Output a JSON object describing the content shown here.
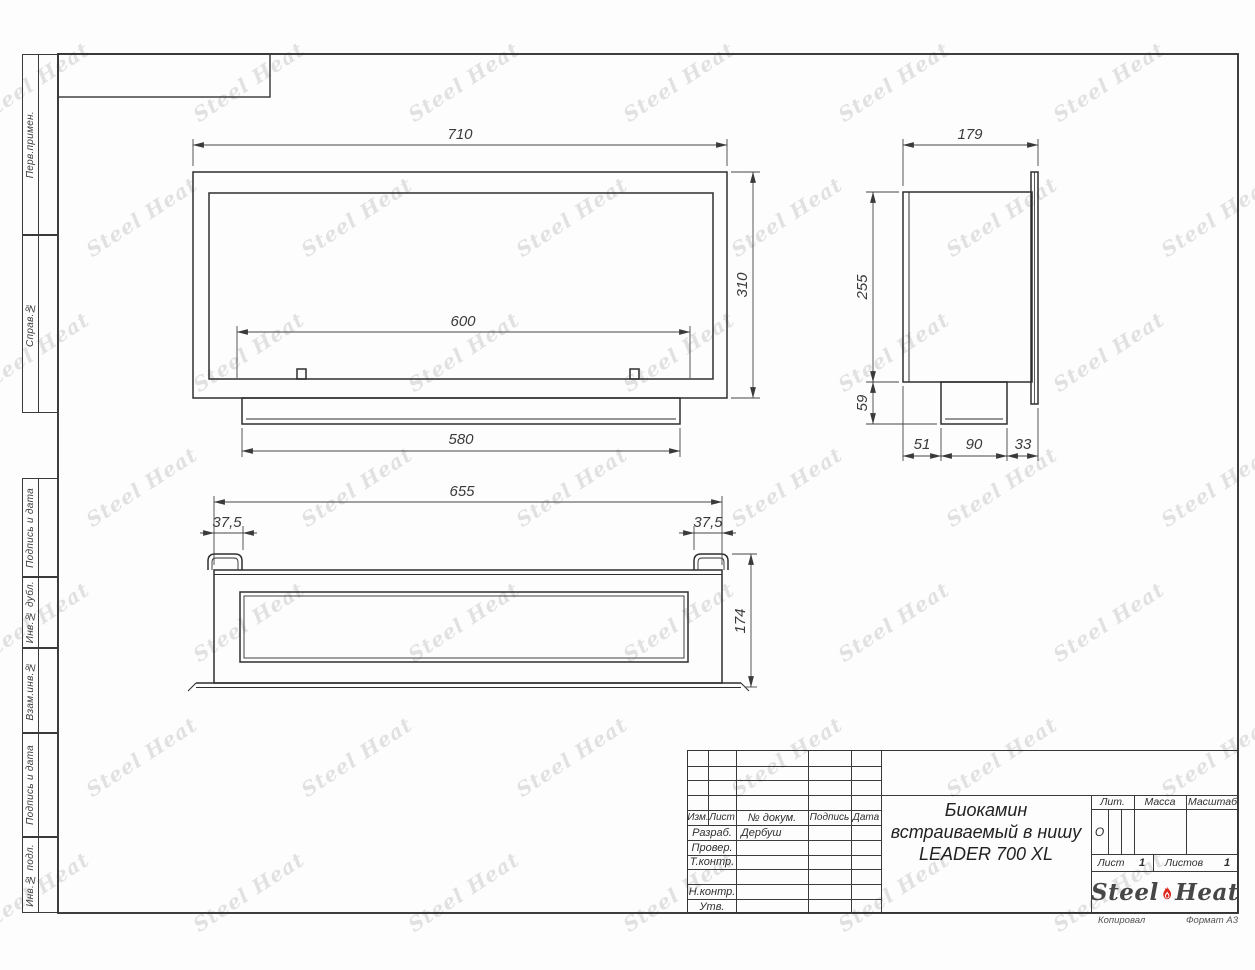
{
  "margins": {
    "items": [
      "Перв.примен.",
      "Справ.№",
      "Подпись и дата",
      "Инв.№ дубл.",
      "Взам.инв.№",
      "Подпись и дата",
      "Инв.№ подл."
    ]
  },
  "views": {
    "front": {
      "w": "710",
      "h": "310",
      "opening": "600",
      "base": "580"
    },
    "side": {
      "depth": "179",
      "h": "255",
      "foot": "59",
      "b1": "51",
      "b2": "90",
      "b3": "33"
    },
    "bottom": {
      "w": "655",
      "off_l": "37,5",
      "off_r": "37,5",
      "d": "174"
    }
  },
  "title_block": {
    "cols": [
      "Изм.",
      "Лист",
      "№ докум.",
      "Подпись",
      "Дата"
    ],
    "rows": [
      {
        "label": "Разраб.",
        "value": "Дербуш"
      },
      {
        "label": "Провер.",
        "value": ""
      },
      {
        "label": "Т.контр.",
        "value": ""
      },
      {
        "label": "",
        "value": ""
      },
      {
        "label": "Н.контр.",
        "value": ""
      },
      {
        "label": "Утв.",
        "value": ""
      }
    ],
    "title_lines": [
      "Биокамин",
      "встраиваемый в нишу",
      "LEADER 700 XL"
    ],
    "lit_label": "Лит.",
    "lit_value": "О",
    "massa_label": "Масса",
    "scale_label": "Масштаб",
    "sheet_label": "Лист",
    "sheet_value": "1",
    "sheets_label": "Листов",
    "sheets_value": "1",
    "logo_left": "Steel",
    "logo_right": "Heat",
    "copied": "Копировал",
    "format": "Формат А3"
  },
  "watermark": {
    "text": "Steel Heat",
    "rows": 7,
    "cols": 6,
    "start_x": -30,
    "start_y": 70,
    "step_x": 215,
    "step_y": 135,
    "row_shift": 108,
    "angle": -33
  },
  "colors": {
    "line": "#343434",
    "accent_red": "#df251f",
    "watermark_gray": "#b5b5b5"
  }
}
